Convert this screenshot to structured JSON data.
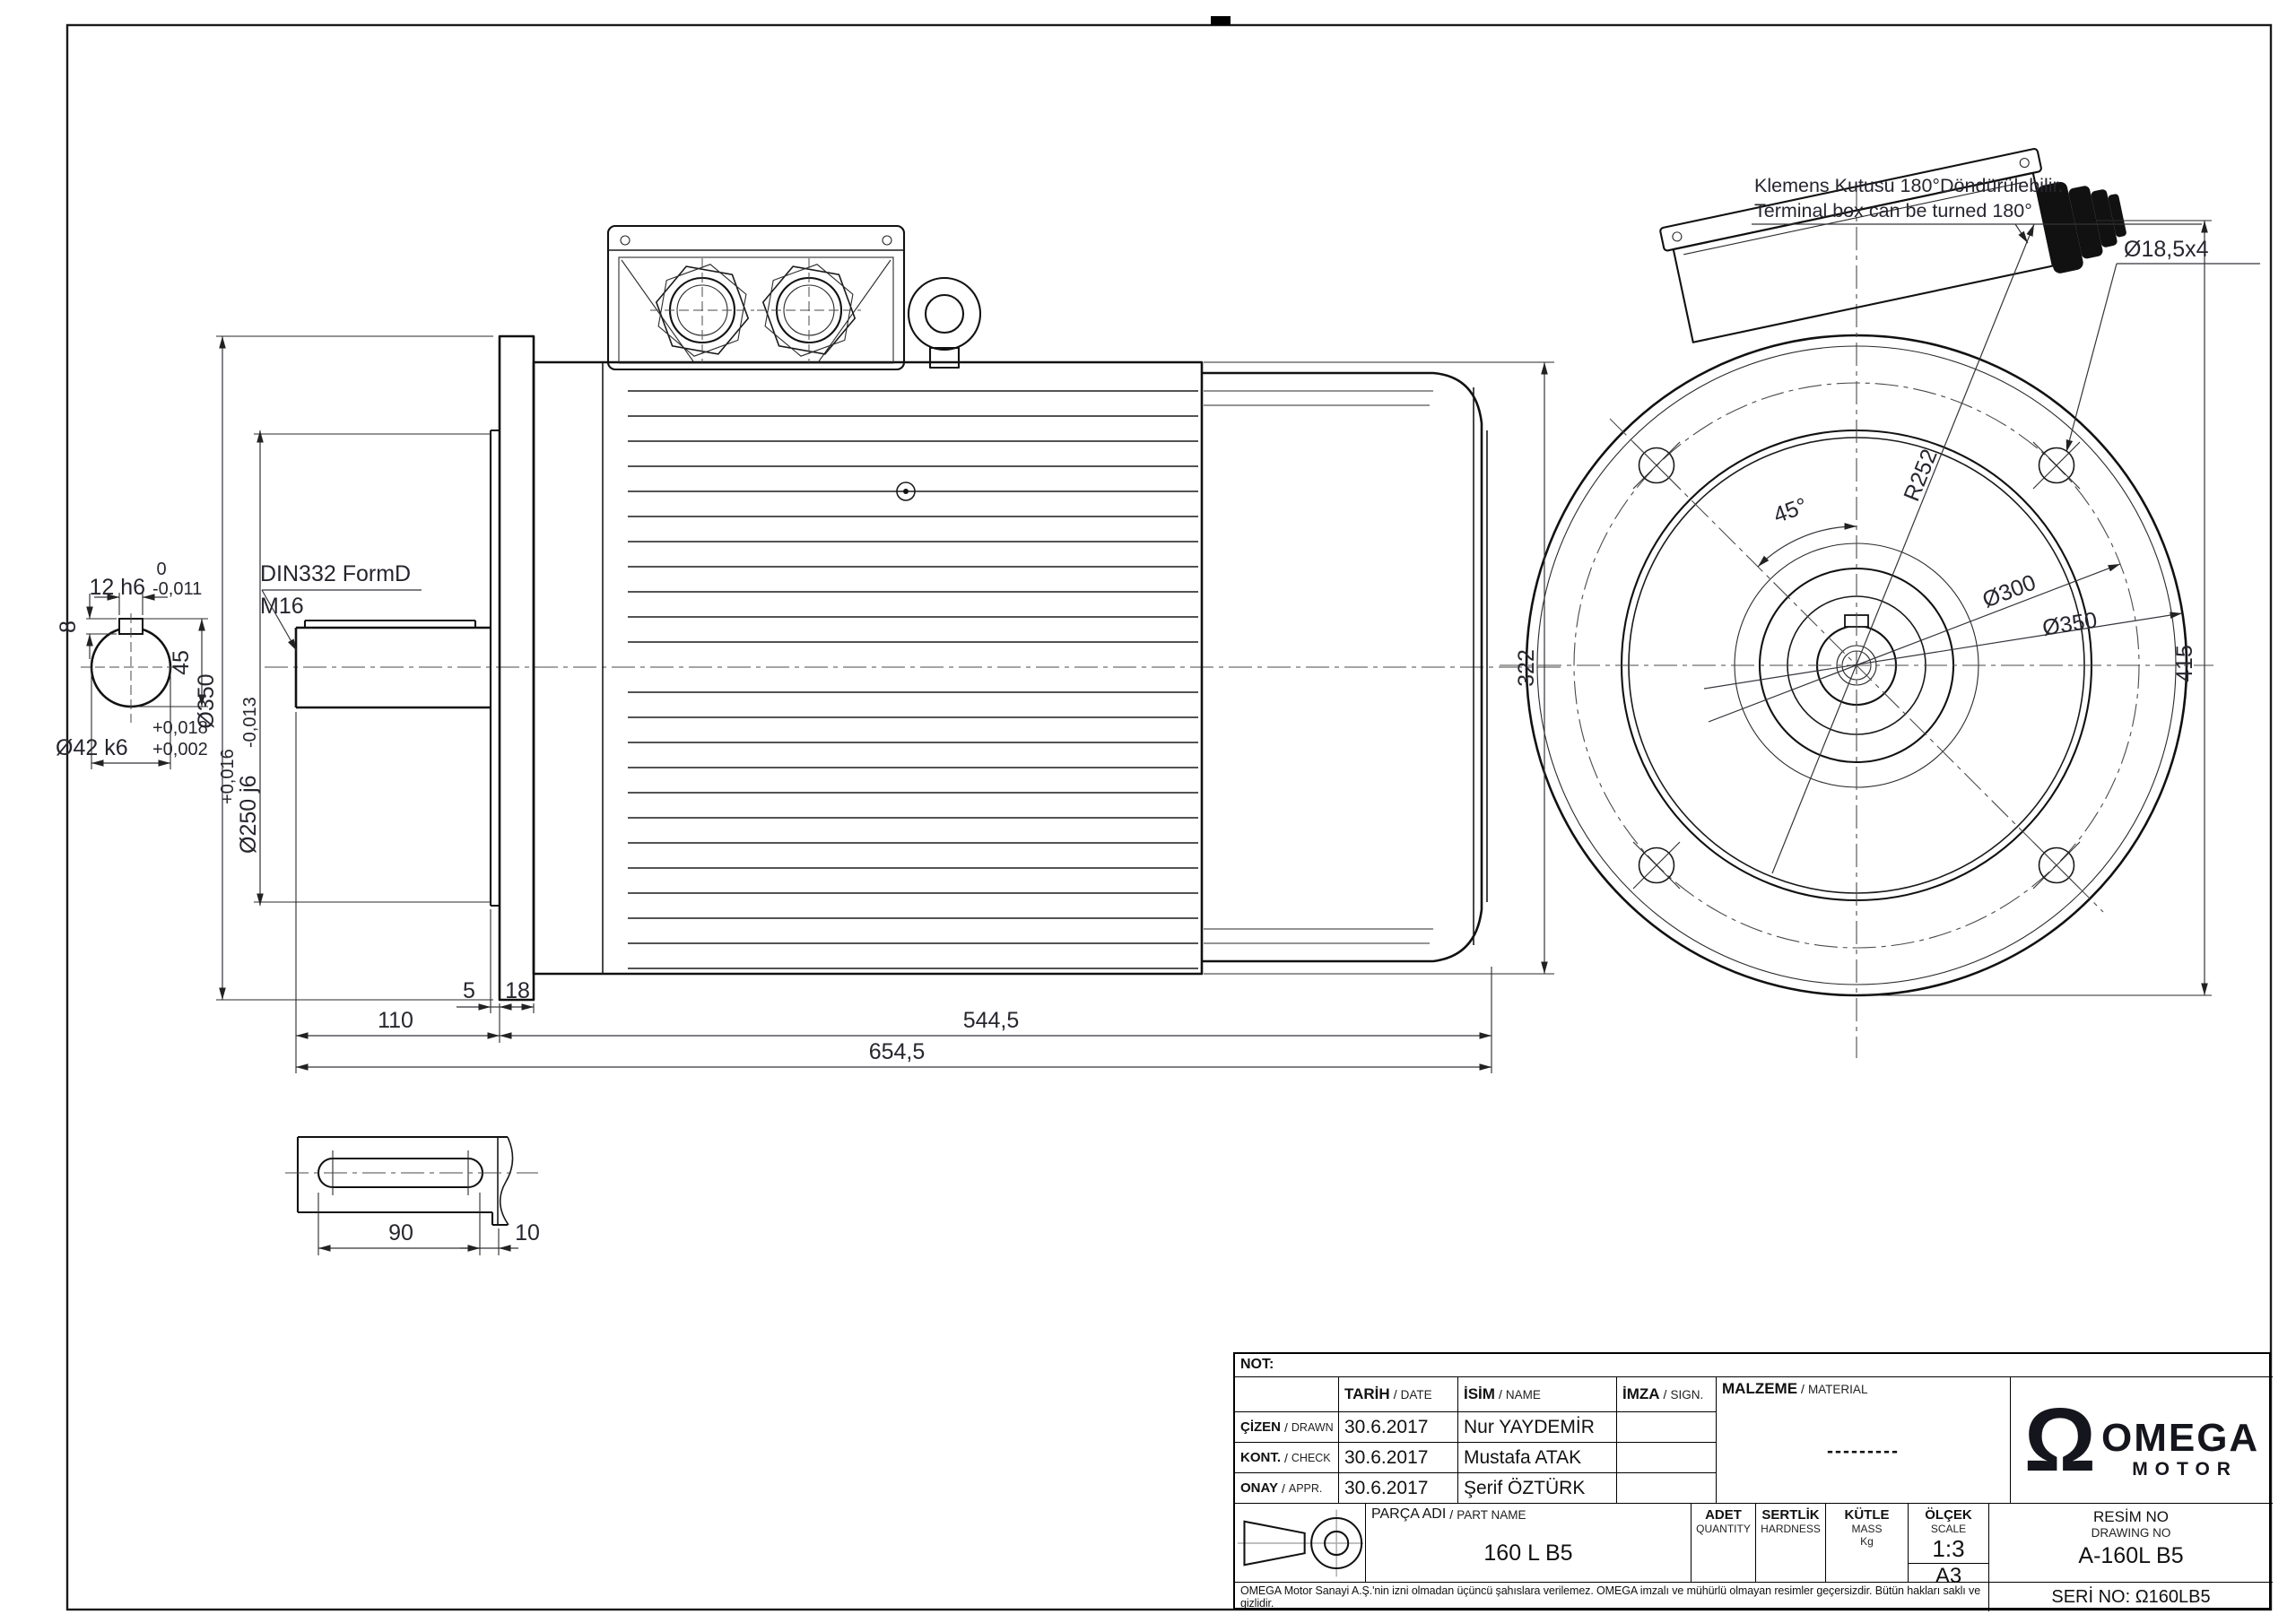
{
  "notes": {
    "terminal_tr": "Klemens Kutusu 180°Döndürülebilir.",
    "terminal_en": "Terminal box can be turned 180°"
  },
  "shaft_detail": {
    "key_width_tol_upper": "0",
    "key_width": "12 h6",
    "key_width_tol_lower": "-0,011",
    "key_height": "8",
    "center_height": "45",
    "shaft_dia": "Ø42 k6",
    "shaft_tol_upper": "+0,018",
    "shaft_tol_lower": "+0,002",
    "center_hole_std": "DIN332 FormD",
    "center_hole_thread": "M16"
  },
  "side_view": {
    "flange_dia": "Ø350",
    "spigot_dia": "Ø250 j6",
    "spigot_tol_upper": "+0,016",
    "spigot_tol_lower": "-0,013",
    "spigot_gap": "5",
    "flange_thickness": "18",
    "shaft_length": "110",
    "body_length": "544,5",
    "total_length": "654,5",
    "frame_height": "322"
  },
  "front_view": {
    "hole_angle": "45°",
    "box_radius": "R252",
    "bolt_circle": "Ø300",
    "flange_od": "Ø350",
    "holes": "Ø18,5x4",
    "overall_height": "415"
  },
  "key_detail": {
    "keyway_length": "90",
    "shoulder": "10"
  },
  "title_block": {
    "not_label": "NOT:",
    "sep": "/",
    "headers": {
      "date_tr": "TARİH",
      "date_en": "DATE",
      "name_tr": "İSİM",
      "name_en": "NAME",
      "sign_tr": "İMZA",
      "sign_en": "SIGN.",
      "material_tr": "MALZEME",
      "material_en": "MATERIAL"
    },
    "rows": [
      {
        "label_tr": "ÇİZEN",
        "label_en": "DRAWN",
        "date": "30.6.2017",
        "name": "Nur YAYDEMİR"
      },
      {
        "label_tr": "KONT.",
        "label_en": "CHECK",
        "date": "30.6.2017",
        "name": "Mustafa ATAK"
      },
      {
        "label_tr": "ONAY",
        "label_en": "APPR.",
        "date": "30.6.2017",
        "name": "Şerif ÖZTÜRK"
      }
    ],
    "material_value": "---------",
    "part": {
      "label_tr": "PARÇA ADI",
      "label_en": "PART NAME",
      "value": "160 L B5"
    },
    "qty": {
      "tr": "ADET",
      "en": "QUANTITY"
    },
    "hardness": {
      "tr": "SERTLİK",
      "en": "HARDNESS"
    },
    "mass": {
      "tr": "KÜTLE",
      "en": "MASS",
      "unit": "Kg"
    },
    "scale": {
      "tr": "ÖLÇEK",
      "en": "SCALE",
      "value": "1:3",
      "paper": "A3"
    },
    "drawing_no": {
      "tr": "RESİM NO",
      "en": "DRAWING NO",
      "value": "A-160L B5"
    },
    "serial": "SERİ NO: Ω160LB5",
    "disclaimer": "OMEGA Motor Sanayi A.Ş.'nin izni olmadan üçüncü şahıslara verilemez. OMEGA imzalı ve mühürlü olmayan resimler geçersizdir. Bütün hakları saklı ve gizlidir.",
    "logo": {
      "symbol": "Ω",
      "name": "OMEGA",
      "sub": "MOTOR"
    }
  }
}
